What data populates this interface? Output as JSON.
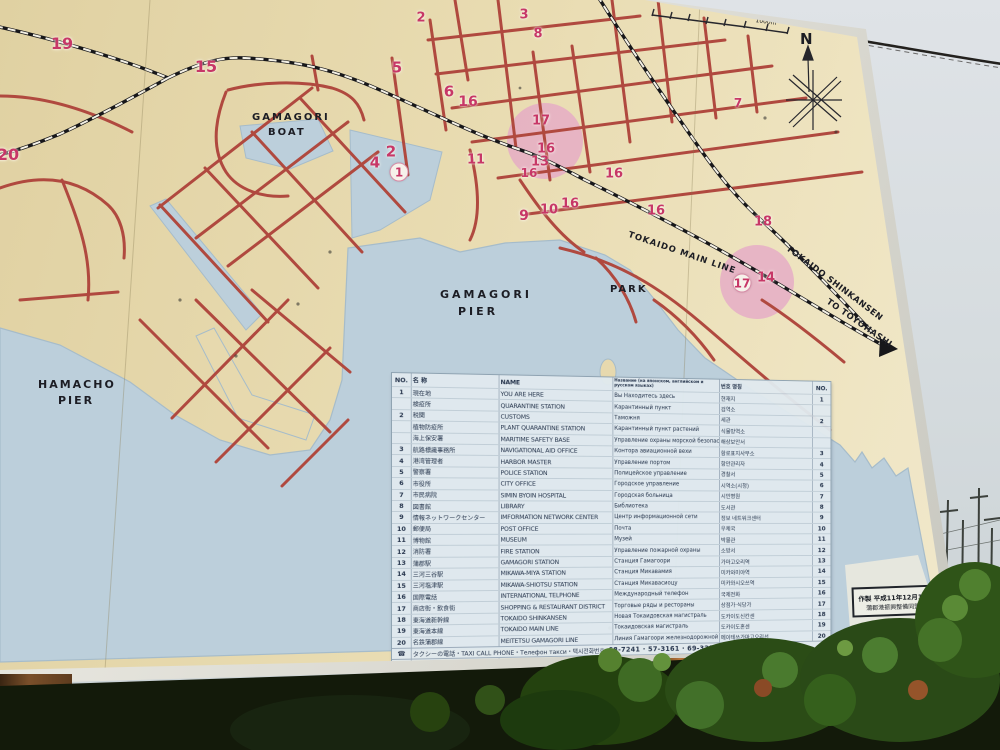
{
  "map": {
    "labels": {
      "boat1": "GAMAGORI",
      "boat2": "BOAT",
      "pier1": "GAMAGORI",
      "pier2": "PIER",
      "hamacho1": "HAMACHO",
      "hamacho2": "PIER",
      "park": "PARK",
      "main_line": "TOKAIDO MAIN LINE",
      "shinkansen": "TOKAIDO SHINKANSEN",
      "toyohashi": "TO TOYOHASHI",
      "north": "N",
      "scale_500": "500m",
      "scale_1000": "1000m"
    },
    "markers": [
      {
        "n": "19",
        "x": 62,
        "y": 44,
        "s": 16
      },
      {
        "n": "15",
        "x": 206,
        "y": 67,
        "s": 16
      },
      {
        "n": "20",
        "x": 8,
        "y": 155,
        "s": 16
      },
      {
        "n": "2",
        "x": 421,
        "y": 18,
        "s": 13
      },
      {
        "n": "3",
        "x": 524,
        "y": 15,
        "s": 13
      },
      {
        "n": "8",
        "x": 538,
        "y": 34,
        "s": 13
      },
      {
        "n": "5",
        "x": 397,
        "y": 68,
        "s": 15
      },
      {
        "n": "6",
        "x": 449,
        "y": 92,
        "s": 15
      },
      {
        "n": "16",
        "x": 468,
        "y": 102,
        "s": 14
      },
      {
        "n": "17",
        "x": 541,
        "y": 121,
        "s": 13
      },
      {
        "n": "16",
        "x": 546,
        "y": 149,
        "s": 13
      },
      {
        "n": "13",
        "x": 540,
        "y": 162,
        "s": 13
      },
      {
        "n": "16",
        "x": 529,
        "y": 173,
        "s": 12
      },
      {
        "n": "11",
        "x": 476,
        "y": 160,
        "s": 13
      },
      {
        "n": "2",
        "x": 391,
        "y": 152,
        "s": 15
      },
      {
        "n": "4",
        "x": 375,
        "y": 163,
        "s": 15
      },
      {
        "n": "1",
        "x": 399,
        "y": 172,
        "s": 12,
        "circled": true
      },
      {
        "n": "9",
        "x": 524,
        "y": 216,
        "s": 14
      },
      {
        "n": "10",
        "x": 549,
        "y": 210,
        "s": 13
      },
      {
        "n": "16",
        "x": 570,
        "y": 204,
        "s": 13
      },
      {
        "n": "16",
        "x": 614,
        "y": 174,
        "s": 13
      },
      {
        "n": "16",
        "x": 656,
        "y": 211,
        "s": 13
      },
      {
        "n": "18",
        "x": 763,
        "y": 222,
        "s": 13
      },
      {
        "n": "17",
        "x": 742,
        "y": 283,
        "s": 12,
        "circled": true
      },
      {
        "n": "14",
        "x": 766,
        "y": 278,
        "s": 13
      },
      {
        "n": "7",
        "x": 738,
        "y": 103,
        "s": 12
      }
    ]
  },
  "legend": {
    "headers": {
      "no": "NO.",
      "jp": "名 称",
      "en": "NAME",
      "ru": "Название (на японском, английском и русском языках)",
      "kr": "번호 명칭",
      "no2": "NO."
    },
    "rows": [
      {
        "no": "1",
        "jp": "現在地",
        "en": "YOU ARE HERE",
        "ru": "Вы Находитесь здесь",
        "kr": "현재지"
      },
      {
        "no": "",
        "jp": "検疫所",
        "en": "QUARANTINE STATION",
        "ru": "Карантинный пункт",
        "kr": "검역소"
      },
      {
        "no": "2",
        "jp": "税関",
        "en": "CUSTOMS",
        "ru": "Таможня",
        "kr": "세관"
      },
      {
        "no": "",
        "jp": "植物防疫所",
        "en": "PLANT QUARANTINE STATION",
        "ru": "Карантинный пункт растений",
        "kr": "식물방역소"
      },
      {
        "no": "",
        "jp": "海上保安署",
        "en": "MARITIME SAFETY BASE",
        "ru": "Управление охраны морской безопасности",
        "kr": "해상보안서"
      },
      {
        "no": "3",
        "jp": "航路標識事務所",
        "en": "NAVIGATIONAL AID OFFICE",
        "ru": "Контора авиационной вехи",
        "kr": "항로표지사무소"
      },
      {
        "no": "4",
        "jp": "港湾管理者",
        "en": "HARBOR MASTER",
        "ru": "Управление портом",
        "kr": "항만관리자"
      },
      {
        "no": "5",
        "jp": "警察署",
        "en": "POLICE STATION",
        "ru": "Полицейское управление",
        "kr": "경찰서"
      },
      {
        "no": "6",
        "jp": "市役所",
        "en": "CITY OFFICE",
        "ru": "Городское управление",
        "kr": "시역소(시청)"
      },
      {
        "no": "7",
        "jp": "市民病院",
        "en": "SIMIN BYOIN HOSPITAL",
        "ru": "Городская больница",
        "kr": "시민병원"
      },
      {
        "no": "8",
        "jp": "図書館",
        "en": "LIBRARY",
        "ru": "Библиотека",
        "kr": "도서관"
      },
      {
        "no": "9",
        "jp": "情報ネットワークセンター",
        "en": "IMFORMATION NETWORK CENTER",
        "ru": "Центр информационной сети",
        "kr": "정보 네트워크센터"
      },
      {
        "no": "10",
        "jp": "郵便局",
        "en": "POST OFFICE",
        "ru": "Почта",
        "kr": "우체국"
      },
      {
        "no": "11",
        "jp": "博物館",
        "en": "MUSEUM",
        "ru": "Музей",
        "kr": "박물관"
      },
      {
        "no": "12",
        "jp": "消防署",
        "en": "FIRE STATION",
        "ru": "Управление пожарной охраны",
        "kr": "소방서"
      },
      {
        "no": "13",
        "jp": "蒲郡駅",
        "en": "GAMAGORI STATION",
        "ru": "Станция Гамагоори",
        "kr": "가마고오리역"
      },
      {
        "no": "14",
        "jp": "三河三谷駅",
        "en": "MIKAWA-MIYA STATION",
        "ru": "Станция Микавамия",
        "kr": "미카와미야역"
      },
      {
        "no": "15",
        "jp": "三河塩津駅",
        "en": "MIKAWA-SHIOTSU STATION",
        "ru": "Станция Микавасиоцу",
        "kr": "미카와시오쓰역"
      },
      {
        "no": "16",
        "jp": "国際電話",
        "en": "INTERNATIONAL TELPHONE",
        "ru": "Международный телефон",
        "kr": "국제전화"
      },
      {
        "no": "17",
        "jp": "商店街・飲食街",
        "en": "SHOPPING & RESTAURANT DISTRICT",
        "ru": "Торговые ряды и рестораны",
        "kr": "상점가·식당가"
      },
      {
        "no": "18",
        "jp": "東海道新幹線",
        "en": "TOKAIDO SHINKANSEN",
        "ru": "Новая Токаидовская магистраль",
        "kr": "도카이도신칸센"
      },
      {
        "no": "19",
        "jp": "東海道本線",
        "en": "TOKAIDO MAIN LINE",
        "ru": "Токаидовская магистраль",
        "kr": "도카이도혼센"
      },
      {
        "no": "20",
        "jp": "名鉄蒲郡線",
        "en": "MEITETSU GAMAGORI LINE",
        "ru": "Линия Гамагоори железнодорожной компании",
        "kr": "메이테쓰가마고오리선"
      }
    ],
    "taxi": {
      "icon": "☎",
      "jp": "タクシーの電話",
      "en": "TAXI CALL PHONE",
      "ru": "Телефон такси",
      "kr": "택시전화번호",
      "phones": "68-7241 · 57-3161 · 69-3211"
    },
    "title": {
      "jp": "蒲郡市内案内看板",
      "en": "GAMAGORI CITY GUIDE MAP",
      "ru": "Справочная доска о городе Гамагоори",
      "kr": "가마고오리시내안내판"
    }
  },
  "info_box": {
    "line1": "作製 平成11年12月19日",
    "line2": "蒲郡港振興整備同盟会"
  },
  "colors": {
    "road": "#b0493f",
    "water": "#bccfdb",
    "sign": "#e9dcb2",
    "highlight": "#e5a8c6",
    "number": "#c73767"
  }
}
